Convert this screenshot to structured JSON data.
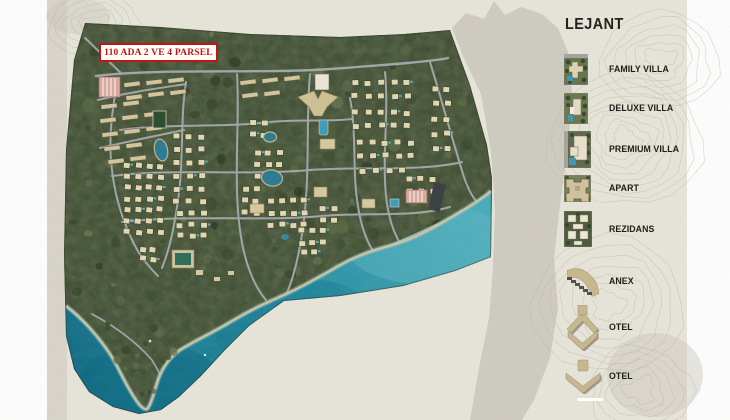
{
  "map": {
    "parcel_label": "110 ADA 2 VE 4 PARSEL"
  },
  "legend": {
    "title": "LEJANT",
    "items": [
      {
        "label": "FAMILY VILLA",
        "icon": "family-villa-icon"
      },
      {
        "label": "DELUXE VILLA",
        "icon": "deluxe-villa-icon"
      },
      {
        "label": "PREMIUM VILLA",
        "icon": "premium-villa-icon"
      },
      {
        "label": "APART",
        "icon": "apart-icon"
      },
      {
        "label": "REZIDANS",
        "icon": "rezidans-icon"
      },
      {
        "label": "ANEX",
        "icon": "anex-icon"
      },
      {
        "label": "OTEL",
        "icon": "otel-wings-icon"
      },
      {
        "label": "OTEL",
        "icon": "otel-arrow-icon"
      }
    ]
  },
  "colors": {
    "paper": "#e8e5da",
    "terrain_gray": "#c9c6bb",
    "forest": "#46523a",
    "sea_deep": "#156e86",
    "sea_light": "#4fadbb",
    "beach": "#d2c3a2",
    "road": "#a6abad",
    "villa": "#e0d7b0",
    "building_tan": "#c6b78d",
    "label_red": "#c41414",
    "pond": "#2e7c92"
  }
}
